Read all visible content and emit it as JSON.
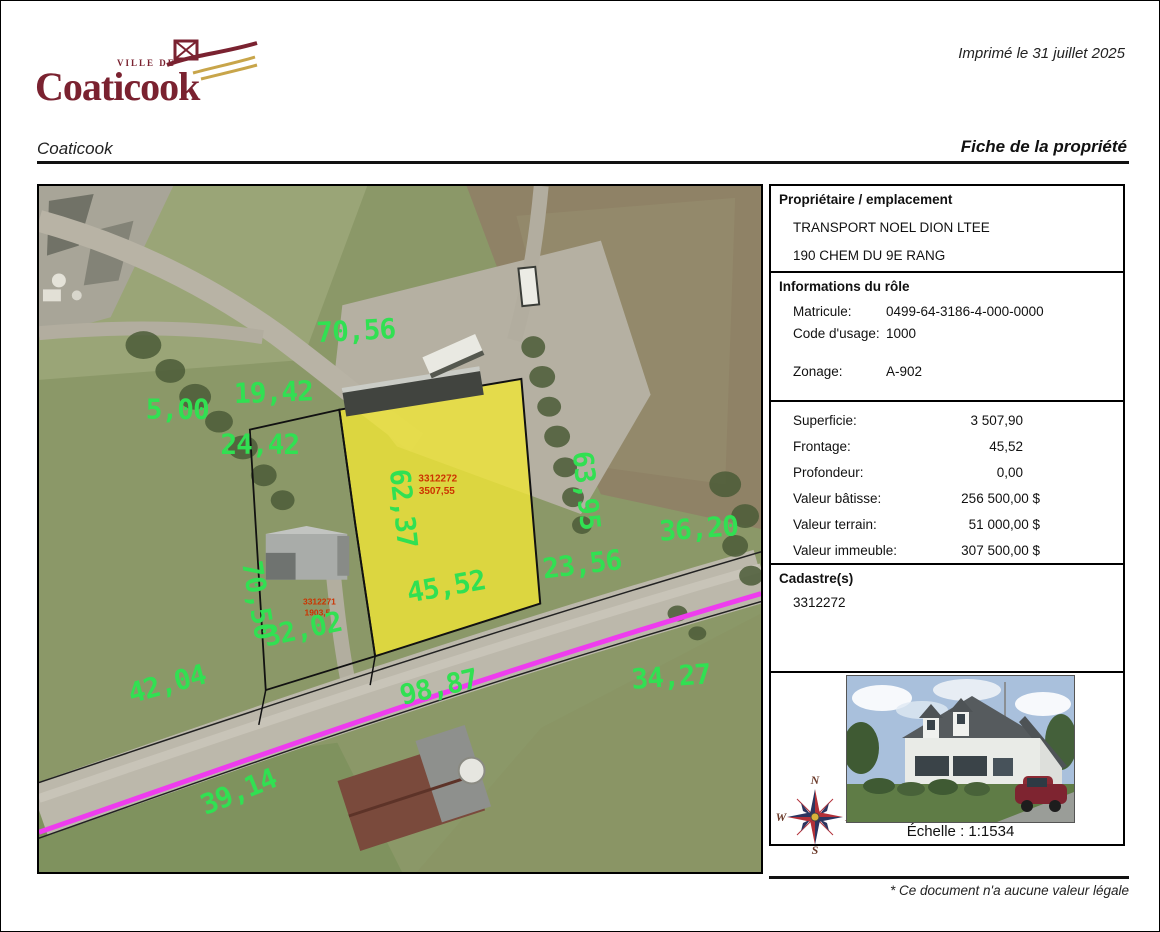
{
  "logo": {
    "ville_de": "VILLE DE",
    "name": "Coaticook"
  },
  "header": {
    "printed": "Imprimé le 31 juillet 2025",
    "municipality": "Coaticook",
    "title": "Fiche de la propriété"
  },
  "panel": {
    "owner": {
      "header": "Propriétaire / emplacement",
      "name": "TRANSPORT NOEL DION LTEE",
      "address": "190 CHEM DU 9E RANG"
    },
    "role": {
      "header": "Informations du rôle",
      "matricule_label": "Matricule:",
      "matricule": "0499-64-3186-4-000-0000",
      "usage_label": "Code d'usage:",
      "usage": "1000",
      "zonage_label": "Zonage:",
      "zonage": "A-902"
    },
    "valuation": {
      "rows": [
        {
          "label": "Superficie:",
          "value": "3 507,90"
        },
        {
          "label": "Frontage:",
          "value": "45,52"
        },
        {
          "label": "Profondeur:",
          "value": "0,00"
        },
        {
          "label": "Valeur bâtisse:",
          "value": "256 500,00 $"
        },
        {
          "label": "Valeur terrain:",
          "value": "51 000,00 $"
        },
        {
          "label": "Valeur immeuble:",
          "value": "307 500,00 $"
        }
      ]
    },
    "cadastre": {
      "header": "Cadastre(s)",
      "number": "3312272"
    },
    "scale_label": "Échelle : 1:1534",
    "compass": {
      "n": "N",
      "e": "E",
      "s": "S",
      "w": "W"
    }
  },
  "map": {
    "parcel_label_line1": "3312272",
    "parcel_label_line2": "3507,55",
    "adjacent_label_line1": "3312271",
    "adjacent_label_line2": "1903,5",
    "measurements": [
      {
        "text": "70,56"
      },
      {
        "text": "5,00"
      },
      {
        "text": "19,42"
      },
      {
        "text": "24,42"
      },
      {
        "text": "62,37"
      },
      {
        "text": "63,95"
      },
      {
        "text": "36,20"
      },
      {
        "text": "23,56"
      },
      {
        "text": "45,52"
      },
      {
        "text": "70,50"
      },
      {
        "text": "32,02"
      },
      {
        "text": "42,04"
      },
      {
        "text": "34,27"
      },
      {
        "text": "98,87"
      },
      {
        "text": "39,14"
      }
    ]
  },
  "footer": {
    "disclaimer": "* Ce document n'a aucune valeur légale"
  },
  "colors": {
    "measurement_green": "#31e052",
    "parcel_yellow": "#f0e636",
    "road_magenta": "#ee3cee",
    "parcel_label_red": "#cc3300",
    "logo_maroon": "#7a2230"
  }
}
